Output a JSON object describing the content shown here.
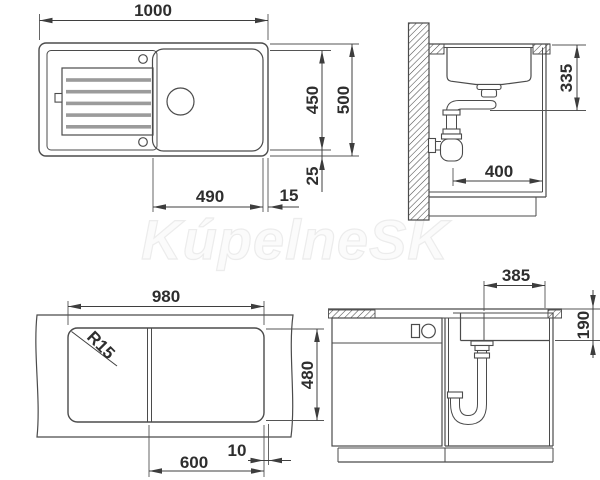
{
  "watermark": {
    "text": "KúpelneSK"
  },
  "views": {
    "plan": {
      "label": "sink top view",
      "dims": {
        "overall_width": "1000",
        "inner_depth": "450",
        "overall_depth": "500",
        "rim_offset": "25",
        "bowl_width": "490",
        "edge_gap": "15"
      }
    },
    "section": {
      "label": "side section view",
      "dims": {
        "drain_depth": "335",
        "clearance_width": "400"
      }
    },
    "cutout": {
      "label": "worktop cutout view",
      "dims": {
        "cutout_width": "980",
        "cutout_depth": "480",
        "bowl_section": "600",
        "gap": "10",
        "corner_radius": "R15"
      }
    },
    "front": {
      "label": "front elevation view",
      "dims": {
        "bowl_width": "385",
        "bowl_depth": "190"
      }
    }
  }
}
